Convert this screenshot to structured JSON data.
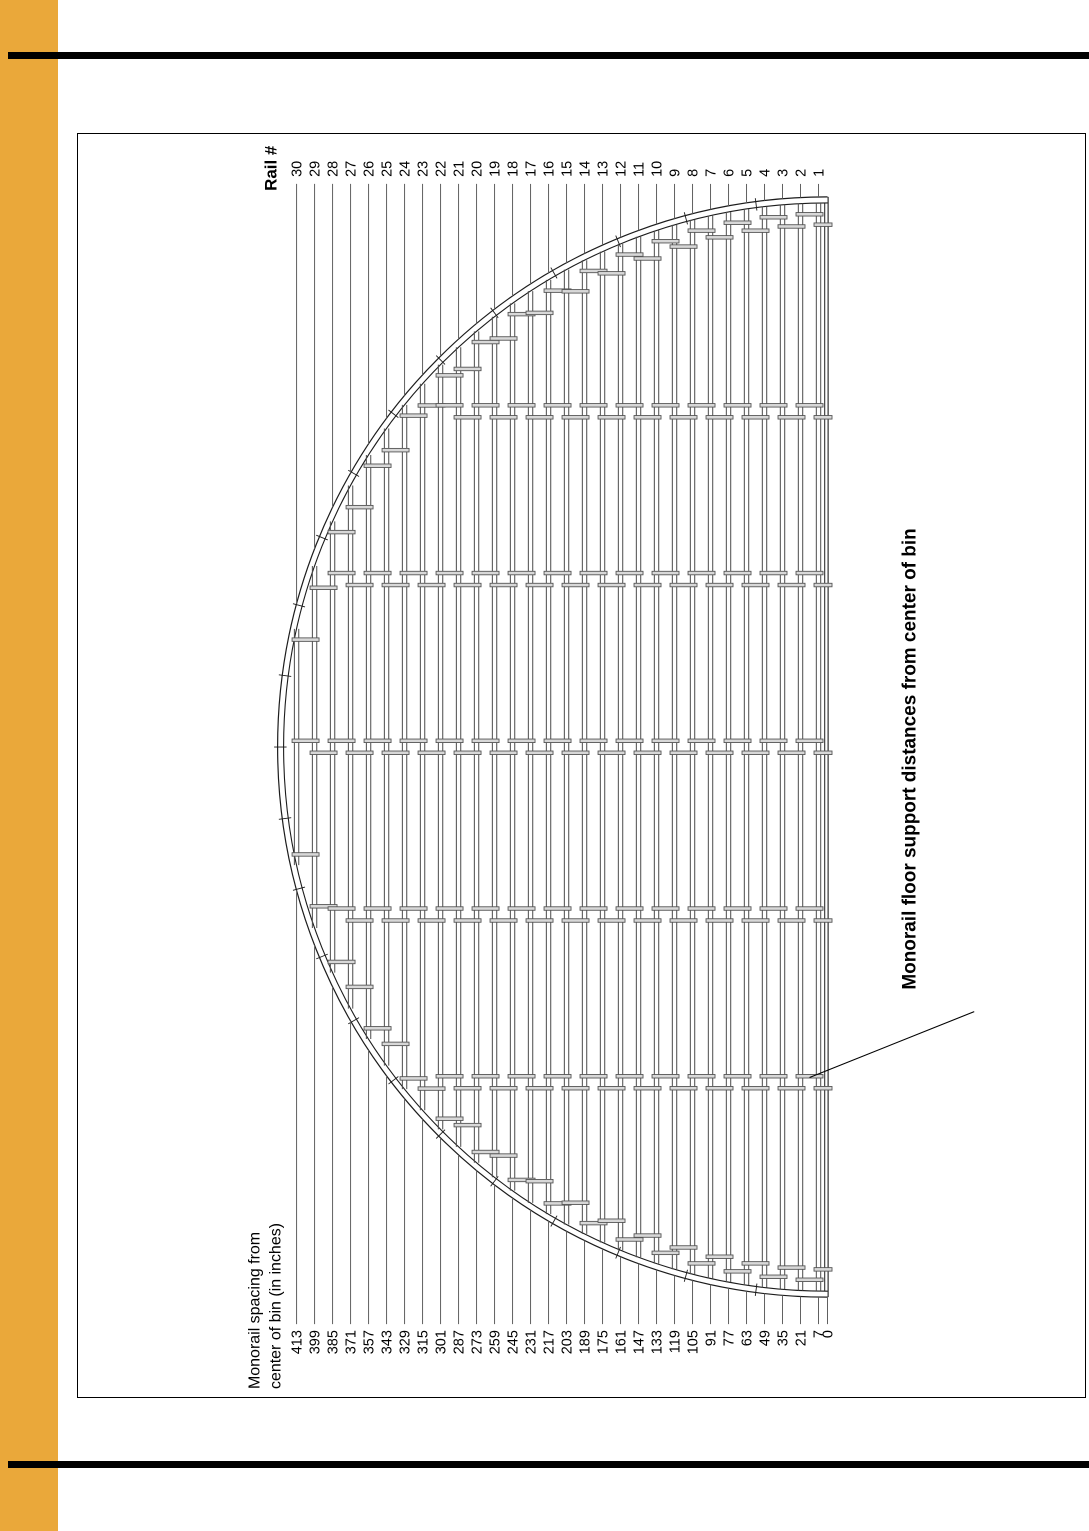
{
  "frame": {
    "accent_color": "#EAA83A",
    "rule_color": "#000000"
  },
  "diagram": {
    "rail_axis_label": "Rail #",
    "spacing_caption_line1": "Monorail spacing from",
    "spacing_caption_line2": "center of bin (in inches)",
    "title": "Monorail floor support distances from center of bin",
    "center_label": "0",
    "rails": [
      {
        "rail": 30,
        "spacing_in": 413
      },
      {
        "rail": 29,
        "spacing_in": 399
      },
      {
        "rail": 28,
        "spacing_in": 385
      },
      {
        "rail": 27,
        "spacing_in": 371
      },
      {
        "rail": 26,
        "spacing_in": 357
      },
      {
        "rail": 25,
        "spacing_in": 343
      },
      {
        "rail": 24,
        "spacing_in": 329
      },
      {
        "rail": 23,
        "spacing_in": 315
      },
      {
        "rail": 22,
        "spacing_in": 301
      },
      {
        "rail": 21,
        "spacing_in": 287
      },
      {
        "rail": 20,
        "spacing_in": 273
      },
      {
        "rail": 19,
        "spacing_in": 259
      },
      {
        "rail": 18,
        "spacing_in": 245
      },
      {
        "rail": 17,
        "spacing_in": 231
      },
      {
        "rail": 16,
        "spacing_in": 217
      },
      {
        "rail": 15,
        "spacing_in": 203
      },
      {
        "rail": 14,
        "spacing_in": 189
      },
      {
        "rail": 13,
        "spacing_in": 175
      },
      {
        "rail": 12,
        "spacing_in": 161
      },
      {
        "rail": 11,
        "spacing_in": 147
      },
      {
        "rail": 10,
        "spacing_in": 133
      },
      {
        "rail": 9,
        "spacing_in": 119
      },
      {
        "rail": 8,
        "spacing_in": 105
      },
      {
        "rail": 7,
        "spacing_in": 91
      },
      {
        "rail": 6,
        "spacing_in": 77
      },
      {
        "rail": 5,
        "spacing_in": 63
      },
      {
        "rail": 4,
        "spacing_in": 49
      },
      {
        "rail": 3,
        "spacing_in": 35
      },
      {
        "rail": 2,
        "spacing_in": 21
      },
      {
        "rail": 1,
        "spacing_in": 7
      }
    ]
  }
}
